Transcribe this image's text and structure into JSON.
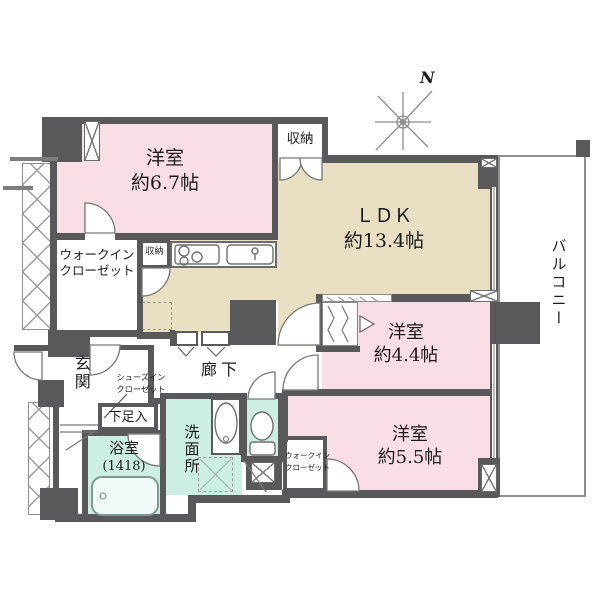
{
  "plan": {
    "compass": "N",
    "balcony": "バルコニー",
    "rooms": {
      "bedroom1": {
        "name": "洋室",
        "size": "約6.7帖"
      },
      "ldk": {
        "name": "ＬＤＫ",
        "size": "約13.4帖"
      },
      "bedroom2": {
        "name": "洋室",
        "size": "約4.4帖"
      },
      "bedroom3": {
        "name": "洋室",
        "size": "約5.5帖"
      },
      "bath": {
        "name": "浴室",
        "size": "(1418)"
      },
      "washroom": {
        "name": "洗面所"
      },
      "genkan": {
        "name": "玄関"
      },
      "hallway": {
        "name": "廊下"
      }
    },
    "closets": {
      "wic1": {
        "line1": "ウォークイン",
        "line2": "クローゼット"
      },
      "wic2": {
        "line1": "ウォークイン",
        "line2": "クローゼット"
      },
      "sic": {
        "line1": "シューズイン",
        "line2": "クローゼット"
      },
      "storage_top": "収納",
      "storage_kitchen": "収納",
      "shoe_cabinet": "下足入"
    },
    "colors": {
      "wall": "#59595b",
      "western_room": "#fadee6",
      "ldk": "#e9dfc2",
      "wet_area": "#cdeee4",
      "balcony_line": "#8f8f8f"
    }
  }
}
